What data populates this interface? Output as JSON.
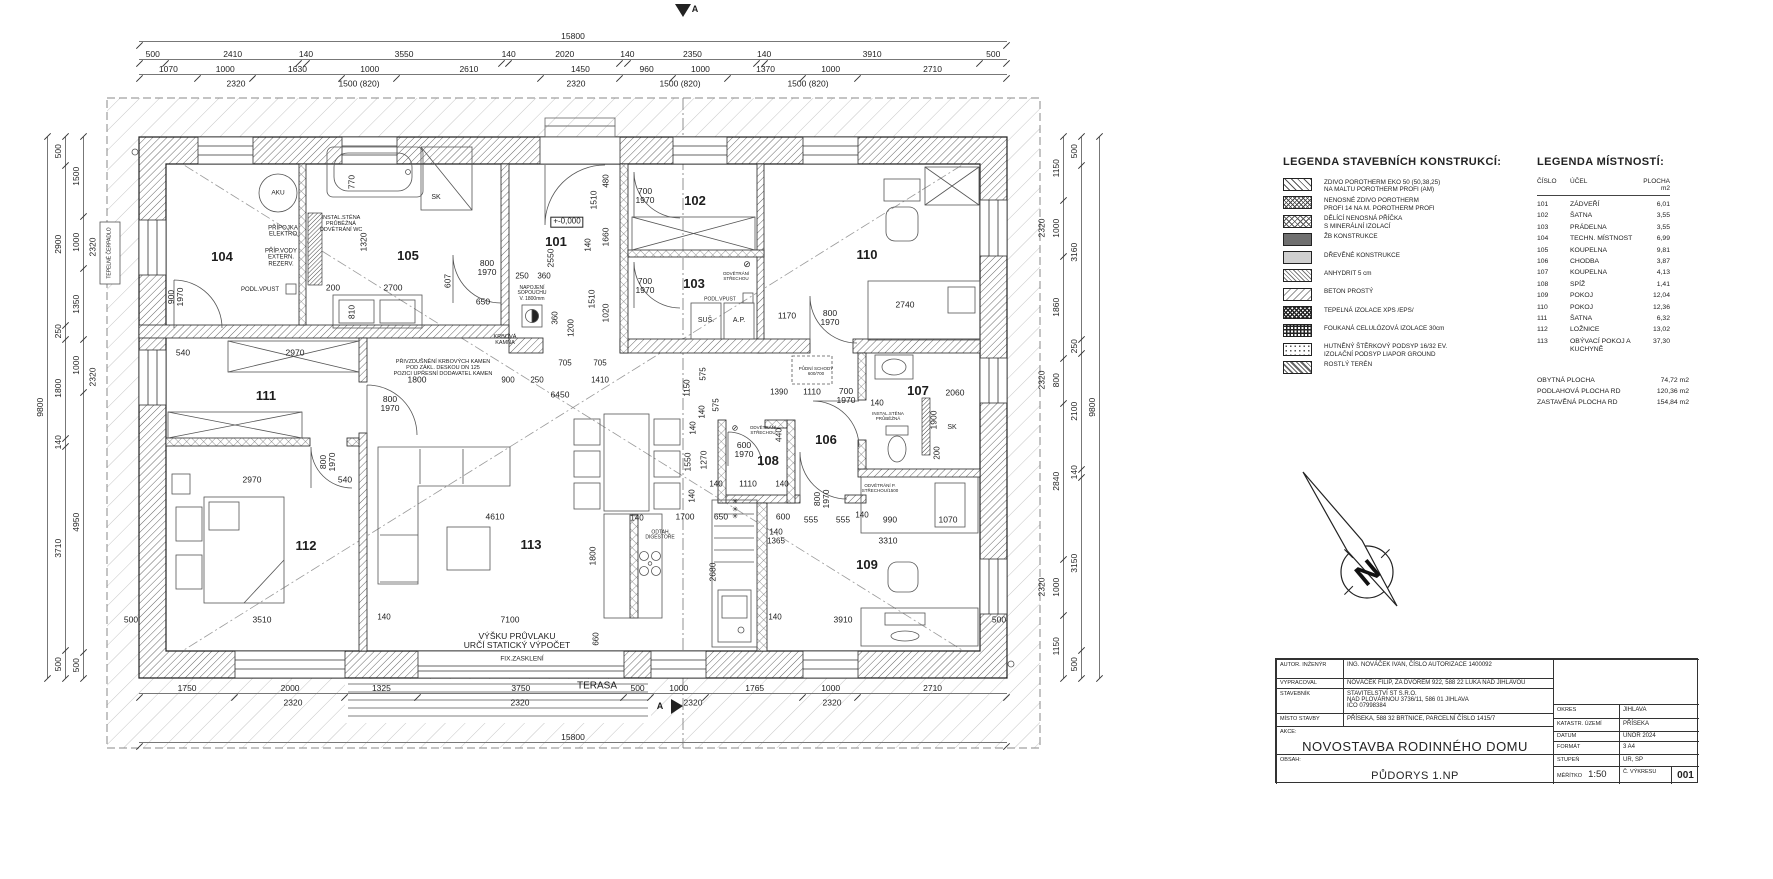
{
  "drawing": {
    "section_marker": "A",
    "overall_width": "15800",
    "overall_height": "9800",
    "dim_rows": [
      {
        "id": "dim-top-overall",
        "x": 139,
        "y": 30,
        "w": 868,
        "vals": [
          "15800"
        ]
      },
      {
        "id": "dim-top-segments",
        "x": 139,
        "y": 48,
        "w": 868,
        "vals": [
          "500",
          "2410",
          "140",
          "3550",
          "140",
          "2020",
          "140",
          "2350",
          "140",
          "3910",
          "500"
        ]
      },
      {
        "id": "dim-top-openings",
        "x": 139,
        "y": 63,
        "w": 868,
        "vals": [
          "1070",
          "1000",
          "1630",
          "1000",
          "2610",
          "1450",
          "960",
          "1000",
          "1370",
          "1000",
          "2710"
        ]
      },
      {
        "id": "dim-bottom-openings",
        "x": 139,
        "y": 682,
        "w": 868,
        "vals": [
          "1750",
          "2000",
          "1325",
          "3750",
          "500",
          "1000",
          "1765",
          "1000",
          "2710"
        ]
      },
      {
        "id": "dim-bottom-overall",
        "x": 139,
        "y": 731,
        "w": 868,
        "vals": [
          "15800"
        ]
      }
    ],
    "dim_cols": [
      {
        "id": "dim-left-overall",
        "x": 34,
        "y": 137,
        "h": 541,
        "vals": [
          "9800"
        ]
      },
      {
        "id": "dim-left-segments",
        "x": 52,
        "y": 137,
        "h": 541,
        "vals": [
          "500",
          "2900",
          "250",
          "1800",
          "140",
          "3710",
          "500"
        ]
      },
      {
        "id": "dim-left-openings",
        "x": 70,
        "y": 137,
        "h": 541,
        "vals": [
          "1500",
          "1000",
          "1350",
          "1000",
          "4950",
          "500"
        ]
      },
      {
        "id": "dim-right-openings",
        "x": 1050,
        "y": 137,
        "h": 541,
        "vals": [
          "1150",
          "1000",
          "1860",
          "800",
          "2840",
          "1000",
          "1150"
        ]
      },
      {
        "id": "dim-right-segments",
        "x": 1068,
        "y": 137,
        "h": 541,
        "vals": [
          "500",
          "3160",
          "250",
          "2100",
          "140",
          "3150",
          "500"
        ]
      },
      {
        "id": "dim-right-overall",
        "x": 1086,
        "y": 137,
        "h": 541,
        "vals": [
          "9800"
        ]
      }
    ],
    "rooms": [
      {
        "n": "101",
        "x": 556,
        "y": 242
      },
      {
        "n": "102",
        "x": 695,
        "y": 201
      },
      {
        "n": "103",
        "x": 694,
        "y": 284
      },
      {
        "n": "104",
        "x": 222,
        "y": 257
      },
      {
        "n": "105",
        "x": 408,
        "y": 256
      },
      {
        "n": "106",
        "x": 826,
        "y": 440
      },
      {
        "n": "107",
        "x": 918,
        "y": 391
      },
      {
        "n": "108",
        "x": 768,
        "y": 461
      },
      {
        "n": "109",
        "x": 867,
        "y": 565
      },
      {
        "n": "110",
        "x": 867,
        "y": 255
      },
      {
        "n": "111",
        "x": 266,
        "y": 396
      },
      {
        "n": "112",
        "x": 306,
        "y": 546
      },
      {
        "n": "113",
        "x": 531,
        "y": 545
      }
    ],
    "labels": [
      {
        "t": "2320",
        "x": 236,
        "y": 84,
        "s": 8.5
      },
      {
        "t": "1500 (820)",
        "x": 359,
        "y": 84,
        "s": 8.5
      },
      {
        "t": "2320",
        "x": 576,
        "y": 84,
        "s": 8.5
      },
      {
        "t": "1500 (820)",
        "x": 680,
        "y": 84,
        "s": 8.5
      },
      {
        "t": "1500 (820)",
        "x": 808,
        "y": 84,
        "s": 8.5
      },
      {
        "t": "A",
        "x": 695,
        "y": 10,
        "s": 9,
        "b": 1
      },
      {
        "t": "A",
        "x": 660,
        "y": 707,
        "s": 9,
        "b": 1
      },
      {
        "t": "TEPELNÉ ČERPADLO",
        "x": 110,
        "y": 253,
        "r": -90,
        "s": 5
      },
      {
        "t": "AKU",
        "x": 278,
        "y": 193,
        "s": 6.5
      },
      {
        "t": "PŘÍPOJKA\nELEKTRO",
        "x": 283,
        "y": 232,
        "s": 6
      },
      {
        "t": "PŘÍP.VODY\nEXTERN.\nREZERV.",
        "x": 281,
        "y": 258,
        "s": 6
      },
      {
        "t": "PODL.VPUST",
        "x": 260,
        "y": 290,
        "s": 6
      },
      {
        "t": "900\n1970",
        "x": 176,
        "y": 297,
        "r": -90,
        "s": 8.5
      },
      {
        "t": "INSTAL.STĚNA\nPRŮBĚŽNÁ\nODVĚTRÁNÍ WC",
        "x": 341,
        "y": 225,
        "s": 5.5
      },
      {
        "t": "770",
        "x": 352,
        "y": 182,
        "r": -90,
        "s": 8.5
      },
      {
        "t": "1320",
        "x": 364,
        "y": 242,
        "r": -90,
        "s": 8.5
      },
      {
        "t": "SK",
        "x": 436,
        "y": 198,
        "s": 7
      },
      {
        "t": "200",
        "x": 333,
        "y": 288,
        "s": 8.5
      },
      {
        "t": "2700",
        "x": 393,
        "y": 288,
        "s": 8.5
      },
      {
        "t": "810",
        "x": 352,
        "y": 312,
        "r": -90,
        "s": 8.5
      },
      {
        "t": "607",
        "x": 448,
        "y": 281,
        "r": -90,
        "s": 8.5
      },
      {
        "t": "800\n1970",
        "x": 487,
        "y": 268,
        "s": 8.5
      },
      {
        "t": "650",
        "x": 483,
        "y": 302,
        "s": 8.5
      },
      {
        "t": "250",
        "x": 522,
        "y": 277,
        "s": 8
      },
      {
        "t": "360",
        "x": 544,
        "y": 277,
        "s": 8
      },
      {
        "t": "NAPOJENÍ\nSOPOUCHU\nV. 1800mm",
        "x": 532,
        "y": 294,
        "s": 5
      },
      {
        "t": "KRBOVÁ\nKAMNA",
        "x": 505,
        "y": 341,
        "s": 5.5
      },
      {
        "t": "540",
        "x": 183,
        "y": 353,
        "s": 8.5
      },
      {
        "t": "2970",
        "x": 295,
        "y": 353,
        "s": 8.5
      },
      {
        "t": "PŘIVZDUŠNĚNÍ KRBOVÝCH KAMEN\nPOD ZÁKL. DESKOU DN 125\nPOZICI UPŘESNÍ DODAVATEL KAMEN",
        "x": 443,
        "y": 369,
        "s": 5.5
      },
      {
        "t": "+-0,000",
        "x": 567,
        "y": 222,
        "s": 8,
        "bx": 1
      },
      {
        "t": "2550",
        "x": 551,
        "y": 258,
        "r": -90,
        "s": 8.5
      },
      {
        "t": "480",
        "x": 607,
        "y": 181,
        "r": -90,
        "s": 8
      },
      {
        "t": "1510",
        "x": 594,
        "y": 200,
        "r": -90,
        "s": 8.5
      },
      {
        "t": "140",
        "x": 589,
        "y": 245,
        "r": -90,
        "s": 8
      },
      {
        "t": "1660",
        "x": 606,
        "y": 237,
        "r": -90,
        "s": 8.5
      },
      {
        "t": "1510",
        "x": 592,
        "y": 299,
        "r": -90,
        "s": 8.5
      },
      {
        "t": "1020",
        "x": 606,
        "y": 313,
        "r": -90,
        "s": 8.5
      },
      {
        "t": "360",
        "x": 556,
        "y": 318,
        "r": -90,
        "s": 8
      },
      {
        "t": "1200",
        "x": 572,
        "y": 328,
        "r": -90,
        "s": 8
      },
      {
        "t": "700\n1970",
        "x": 645,
        "y": 196,
        "s": 8.5
      },
      {
        "t": "700\n1970",
        "x": 645,
        "y": 286,
        "s": 8.5
      },
      {
        "t": "⊘",
        "x": 747,
        "y": 265,
        "s": 9
      },
      {
        "t": "ODVĚTRÁNÍ\nSTŘECHOU",
        "x": 736,
        "y": 277,
        "s": 4.5
      },
      {
        "t": "PODL.VPUST",
        "x": 720,
        "y": 300,
        "s": 5
      },
      {
        "t": "SUŠ.",
        "x": 706,
        "y": 321,
        "s": 7
      },
      {
        "t": "A.P.",
        "x": 739,
        "y": 321,
        "s": 7
      },
      {
        "t": "1170",
        "x": 787,
        "y": 316,
        "s": 8.5
      },
      {
        "t": "2740",
        "x": 905,
        "y": 305,
        "s": 8.5
      },
      {
        "t": "800\n1970",
        "x": 830,
        "y": 318,
        "s": 8.5
      },
      {
        "t": "PŮDNÍ SCHODY\n600/700",
        "x": 816,
        "y": 372,
        "s": 4.5
      },
      {
        "t": "1390",
        "x": 779,
        "y": 393,
        "s": 8
      },
      {
        "t": "1110",
        "x": 812,
        "y": 392,
        "s": 8.5
      },
      {
        "t": "700\n1970",
        "x": 846,
        "y": 396,
        "s": 8.5
      },
      {
        "t": "140",
        "x": 877,
        "y": 404,
        "s": 8
      },
      {
        "t": "2060",
        "x": 955,
        "y": 393,
        "s": 8.5
      },
      {
        "t": "INSTAL.STĚNA\nPRŮBĚŽNÁ",
        "x": 888,
        "y": 417,
        "s": 4.5
      },
      {
        "t": "1900",
        "x": 934,
        "y": 420,
        "r": -90,
        "s": 8.5
      },
      {
        "t": "200",
        "x": 938,
        "y": 453,
        "r": -90,
        "s": 8
      },
      {
        "t": "SK",
        "x": 952,
        "y": 428,
        "s": 7
      },
      {
        "t": "1150",
        "x": 688,
        "y": 388,
        "r": -90,
        "s": 8
      },
      {
        "t": "575",
        "x": 704,
        "y": 374,
        "r": -90,
        "s": 8
      },
      {
        "t": "575",
        "x": 717,
        "y": 405,
        "r": -90,
        "s": 8
      },
      {
        "t": "140",
        "x": 703,
        "y": 412,
        "r": -90,
        "s": 8
      },
      {
        "t": "140",
        "x": 694,
        "y": 428,
        "r": -90,
        "s": 8
      },
      {
        "t": "1550",
        "x": 688,
        "y": 462,
        "r": -90,
        "s": 8.5
      },
      {
        "t": "1270",
        "x": 704,
        "y": 460,
        "r": -90,
        "s": 8.5
      },
      {
        "t": "140",
        "x": 693,
        "y": 496,
        "r": -90,
        "s": 8
      },
      {
        "t": "⊘",
        "x": 735,
        "y": 429,
        "s": 8
      },
      {
        "t": "ODVĚTRÁNÍ\nSTŘECHOU",
        "x": 763,
        "y": 431,
        "s": 4.5
      },
      {
        "t": "600\n1970",
        "x": 744,
        "y": 450,
        "s": 8.5
      },
      {
        "t": "440",
        "x": 779,
        "y": 435,
        "r": -90,
        "s": 8.5
      },
      {
        "t": "1110",
        "x": 748,
        "y": 484,
        "s": 8.5
      },
      {
        "t": "140",
        "x": 716,
        "y": 485,
        "s": 8
      },
      {
        "t": "140",
        "x": 782,
        "y": 485,
        "s": 8
      },
      {
        "t": "800\n1970",
        "x": 822,
        "y": 499,
        "r": -90,
        "s": 8.5
      },
      {
        "t": "650",
        "x": 721,
        "y": 517,
        "s": 8.5
      },
      {
        "t": "✳\n✳\n✳",
        "x": 735,
        "y": 510,
        "s": 7
      },
      {
        "t": "600",
        "x": 783,
        "y": 517,
        "s": 8.5
      },
      {
        "t": "555",
        "x": 811,
        "y": 520,
        "s": 8.5
      },
      {
        "t": "555",
        "x": 843,
        "y": 520,
        "s": 8.5
      },
      {
        "t": "140",
        "x": 862,
        "y": 516,
        "s": 8
      },
      {
        "t": "990",
        "x": 890,
        "y": 520,
        "s": 8.5
      },
      {
        "t": "1070",
        "x": 948,
        "y": 520,
        "s": 8.5
      },
      {
        "t": "140\n1365",
        "x": 776,
        "y": 537,
        "s": 8
      },
      {
        "t": "3310",
        "x": 888,
        "y": 541,
        "s": 8.5
      },
      {
        "t": "ODVĚTRÁNÍ P.\nSTŘECHOU/1500",
        "x": 880,
        "y": 489,
        "s": 4.5
      },
      {
        "t": "2680",
        "x": 713,
        "y": 572,
        "r": -90,
        "s": 8.5
      },
      {
        "t": "140",
        "x": 775,
        "y": 618,
        "s": 8
      },
      {
        "t": "3910",
        "x": 843,
        "y": 620,
        "s": 8.5
      },
      {
        "t": "500",
        "x": 999,
        "y": 620,
        "s": 8.5
      },
      {
        "t": "4610",
        "x": 495,
        "y": 517,
        "s": 8.5
      },
      {
        "t": "140",
        "x": 637,
        "y": 519,
        "s": 8
      },
      {
        "t": "1700",
        "x": 685,
        "y": 517,
        "s": 8.5
      },
      {
        "t": "1800",
        "x": 593,
        "y": 556,
        "r": -90,
        "s": 8.5
      },
      {
        "t": "ODTAH\nDIGESTOŘE",
        "x": 660,
        "y": 536,
        "s": 5
      },
      {
        "t": "7100",
        "x": 510,
        "y": 620,
        "s": 8.5
      },
      {
        "t": "660",
        "x": 597,
        "y": 639,
        "r": -90,
        "s": 8
      },
      {
        "t": "VÝŠKU PRŮVLAKU\nURČÍ STATICKÝ VÝPOČET",
        "x": 517,
        "y": 641,
        "s": 8.5
      },
      {
        "t": "FIX.ZASKLENÍ",
        "x": 522,
        "y": 659,
        "s": 6.5
      },
      {
        "t": "TERASA",
        "x": 597,
        "y": 687,
        "s": 10
      },
      {
        "t": "3510",
        "x": 262,
        "y": 620,
        "s": 8.5
      },
      {
        "t": "140",
        "x": 384,
        "y": 618,
        "s": 8
      },
      {
        "t": "500",
        "x": 131,
        "y": 620,
        "s": 8.5
      },
      {
        "t": "1800",
        "x": 417,
        "y": 380,
        "s": 8.5
      },
      {
        "t": "800\n1970",
        "x": 390,
        "y": 404,
        "s": 8.5
      },
      {
        "t": "2970",
        "x": 252,
        "y": 480,
        "s": 8.5
      },
      {
        "t": "540",
        "x": 345,
        "y": 480,
        "s": 8.5
      },
      {
        "t": "800\n1970",
        "x": 328,
        "y": 462,
        "r": -90,
        "s": 8.5
      },
      {
        "t": "705",
        "x": 565,
        "y": 364,
        "s": 8
      },
      {
        "t": "705",
        "x": 600,
        "y": 364,
        "s": 8
      },
      {
        "t": "900",
        "x": 508,
        "y": 381,
        "s": 8
      },
      {
        "t": "250",
        "x": 537,
        "y": 381,
        "s": 8
      },
      {
        "t": "1410",
        "x": 600,
        "y": 381,
        "s": 8
      },
      {
        "t": "6450",
        "x": 560,
        "y": 395,
        "s": 8.5
      },
      {
        "t": "2320",
        "x": 293,
        "y": 703,
        "s": 8.5
      },
      {
        "t": "2320",
        "x": 520,
        "y": 703,
        "s": 8.5
      },
      {
        "t": "2320",
        "x": 693,
        "y": 703,
        "s": 8.5
      },
      {
        "t": "2320",
        "x": 832,
        "y": 703,
        "s": 8.5
      },
      {
        "t": "2320",
        "x": 93,
        "y": 247,
        "r": -90,
        "s": 8.5
      },
      {
        "t": "2320",
        "x": 93,
        "y": 377,
        "r": -90,
        "s": 8.5
      },
      {
        "t": "2320",
        "x": 1042,
        "y": 228,
        "r": -90,
        "s": 8.5
      },
      {
        "t": "2320",
        "x": 1042,
        "y": 380,
        "r": -90,
        "s": 8.5
      },
      {
        "t": "2320",
        "x": 1042,
        "y": 587,
        "r": -90,
        "s": 8.5
      }
    ]
  },
  "legend_constructions": {
    "title": "LEGENDA STAVEBNÍCH KONSTRUKCÍ:",
    "items": [
      {
        "pattern": "zdivo",
        "label": "ZDIVO POROTHERM EKO 50 (50,38,25)\nNA MALTU POROTHERM PROFI (AM)"
      },
      {
        "pattern": "nenosne",
        "label": "NENOSNÉ ZDIVO POROTHERM\nPROFI 14 NA M. POROTHERM PROFI"
      },
      {
        "pattern": "pricka",
        "label": "DĚLÍCÍ NENOSNÁ PŘÍČKA\nS MINERÁLNÍ IZOLACÍ"
      },
      {
        "pattern": "zb",
        "label": "ŽB KONSTRUKCE"
      },
      {
        "pattern": "drevo",
        "label": "DŘEVĚNÉ KONSTRUKCE"
      },
      {
        "pattern": "anhydrit",
        "label": "ANHYDRIT 5 cm"
      },
      {
        "pattern": "beton",
        "label": "BETON PROSTÝ"
      },
      {
        "pattern": "xps",
        "label": "TEPELNÁ IZOLACE XPS /EPS/"
      },
      {
        "pattern": "celuloza",
        "label": "FOUKANÁ CELULÓZOVÁ IZOLACE 30cm"
      },
      {
        "pattern": "sterk",
        "label": "HUTNĚNÝ ŠTĚRKOVÝ PODSYP 16/32 EV.\nIZOLAČNÍ PODSYP LIAPOR GROUND"
      },
      {
        "pattern": "teren",
        "label": "ROSTLÝ TERÉN"
      }
    ]
  },
  "legend_rooms": {
    "title": "LEGENDA MÍSTNOSTÍ:",
    "col_number": "ČÍSLO",
    "col_purpose": "ÚČEL",
    "col_area": "PLOCHA m2",
    "rows": [
      {
        "number": "101",
        "purpose": "ZÁDVEŘÍ",
        "area": "6,01"
      },
      {
        "number": "102",
        "purpose": "ŠATNA",
        "area": "3,55"
      },
      {
        "number": "103",
        "purpose": "PRÁDELNA",
        "area": "3,55"
      },
      {
        "number": "104",
        "purpose": "TECHN. MÍSTNOST",
        "area": "6,99"
      },
      {
        "number": "105",
        "purpose": "KOUPELNA",
        "area": "9,81"
      },
      {
        "number": "106",
        "purpose": "CHODBA",
        "area": "3,87"
      },
      {
        "number": "107",
        "purpose": "KOUPELNA",
        "area": "4,13"
      },
      {
        "number": "108",
        "purpose": "SPÍŽ",
        "area": "1,41"
      },
      {
        "number": "109",
        "purpose": "POKOJ",
        "area": "12,04"
      },
      {
        "number": "110",
        "purpose": "POKOJ",
        "area": "12,36"
      },
      {
        "number": "111",
        "purpose": "ŠATNA",
        "area": "6,32"
      },
      {
        "number": "112",
        "purpose": "LOŽNICE",
        "area": "13,02"
      },
      {
        "number": "113",
        "purpose": "OBÝVACÍ POKOJ A KUCHYNĚ",
        "area": "37,30"
      }
    ],
    "summary": [
      {
        "label": "OBYTNÁ PLOCHA",
        "value": "74,72 m2"
      },
      {
        "label": "PODLAHOVÁ PLOCHA RD",
        "value": "120,36 m2"
      },
      {
        "label": "ZASTAVĚNÁ PLOCHA RD",
        "value": "154,84 m2"
      }
    ]
  },
  "title_block": {
    "author_label": "AUTOR.  INŽENÝR",
    "author_value": "ING. NOVÁČEK IVAN, ČÍSLO AUTORIZACE 1400092",
    "vypracoval_label": "VYPRACOVAL",
    "vypracoval_value": "NOVÁČEK FILIP, ZA DVOREM 922, 588 22 LUKA NAD JIHLAVOU",
    "stavebnik_label": "STAVEBNÍK",
    "stavebnik_value": "STAVITELSTVÍ ST S.R.O.\nNAD PLOVÁRNOU 3736/11, 586 01 JIHLAVA\nIČO 07998384",
    "misto_label": "MÍSTO STAVBY",
    "misto_value": "PŘÍSEKA, 588 32 BRTNICE, PARCELNÍ ČÍSLO 1415/7",
    "akce_label": "AKCE:",
    "akce_value": "NOVOSTAVBA RODINNÉHO DOMU",
    "obsah_label": "OBSAH:",
    "obsah_value": "PŮDORYS 1.NP",
    "okres_label": "OKRES",
    "okres_value": "JIHLAVA",
    "katastr_label": "KATASTR. ÚZEMÍ",
    "katastr_value": "PŘÍSEKA",
    "datum_label": "DATUM",
    "datum_value": "ÚNOR 2024",
    "format_label": "FORMÁT",
    "format_value": "3 A4",
    "stupen_label": "STUPEŇ",
    "stupen_value": "UR, SP",
    "meritko_label": "MĚŘÍTKO",
    "meritko_value": "1:50",
    "vykres_label": "Č. VÝKRESU",
    "vykres_value": "001"
  },
  "compass": {
    "letter": "N"
  }
}
